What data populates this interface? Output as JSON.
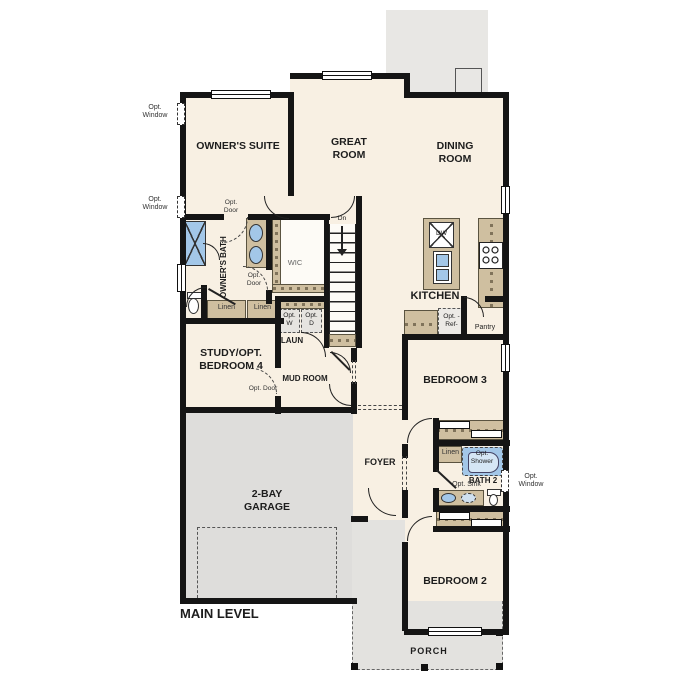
{
  "plan_title": "MAIN LEVEL",
  "rooms": {
    "owners_suite": "OWNER'S SUITE",
    "great_room": "GREAT ROOM",
    "dining_room": "DINING ROOM",
    "kitchen": "KITCHEN",
    "owners_bath": "OWNER'S BATH",
    "wic": "WIC",
    "study": "STUDY/OPT. BEDROOM 4",
    "laundry": "LAUN",
    "mud_room": "MUD ROOM",
    "foyer": "FOYER",
    "garage": "2-BAY GARAGE",
    "bedroom3": "BEDROOM 3",
    "bedroom2": "BEDROOM 2",
    "bath2": "BATH 2",
    "pantry": "Pantry",
    "porch": "PORCH"
  },
  "fixtures": {
    "dishwasher": "DW",
    "opt_ref": "Opt. -Ref-",
    "opt_washer": "Opt. W",
    "opt_dryer": "Opt. D",
    "linen": "Linen",
    "opt_shower": "Opt. Shower",
    "opt_sink": "Opt. Sink"
  },
  "annotations": {
    "opt_window": "Opt. Window",
    "opt_door": "Opt. Door",
    "stairs_down": "Dn"
  },
  "colors": {
    "floor_cream": "#f8f0e3",
    "wall_black": "#151515",
    "counter_tan": "#cfbfa0",
    "fixture_blue": "#a3c7e8",
    "garage_gray": "#dedddb",
    "patio_gray": "#e8e7e4"
  }
}
